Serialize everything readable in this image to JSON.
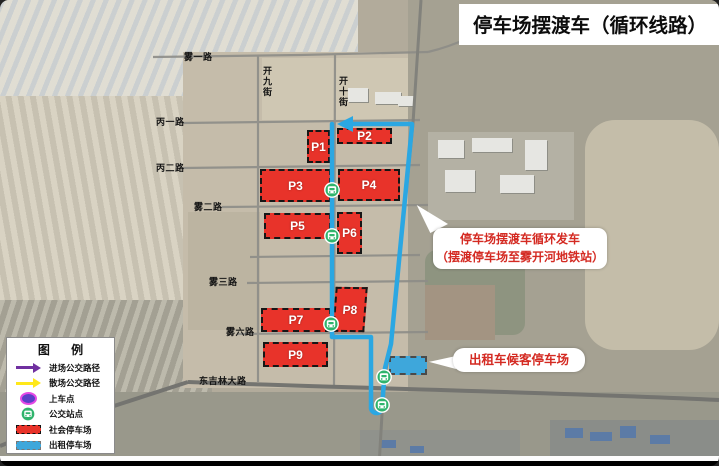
{
  "title": "停车场摆渡车（循环线路）",
  "map": {
    "roads": [
      "雾一路",
      "开九街",
      "开十街",
      "丙一路",
      "丙二路",
      "雾二路",
      "雾三路",
      "雾六路",
      "东吉林大路"
    ],
    "parking_lots": [
      "P1",
      "P2",
      "P3",
      "P4",
      "P5",
      "P6",
      "P7",
      "P8",
      "P9"
    ]
  },
  "callouts": {
    "shuttle_line1": "停车场摆渡车循环发车",
    "shuttle_line2": "（摆渡停车场至雾开河地铁站）",
    "taxi": "出租车候客停车场"
  },
  "legend": {
    "title": "图  例",
    "items": [
      {
        "label": "进场公交路径"
      },
      {
        "label": "散场公交路径"
      },
      {
        "label": "上车点"
      },
      {
        "label": "公交站点"
      },
      {
        "label": "社会停车场"
      },
      {
        "label": "出租停车场"
      }
    ]
  },
  "colors": {
    "route": "#2BA7E2",
    "social_parking": "#E8332A",
    "taxi_parking": "#3EA7DB",
    "bus_stop": "#2FB46C",
    "entry_route_arrow": "#7030A0",
    "exit_route_arrow": "#FFE81A",
    "boarding_point": "#5B3FC8",
    "annotation_text": "#D42A22"
  }
}
